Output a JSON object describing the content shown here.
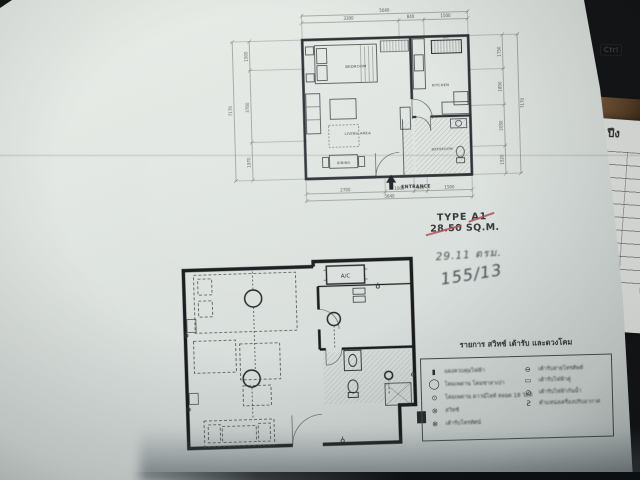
{
  "colors": {
    "background": "#131416",
    "paper": "#dde3df",
    "ink": "#30343a",
    "wall_ink": "#1a1c1e",
    "red_mark": "#b3505e",
    "pencil": "#4b5054"
  },
  "upper_plan": {
    "labels": {
      "bedroom": "BEDROOM",
      "living": "LIVING AREA",
      "dining": "DINING",
      "kitchen": "KITCHEN",
      "bathroom": "BATHROOM",
      "ac": "A/C",
      "entrance": "ENTRANCE"
    },
    "dims": {
      "top_total": "5640",
      "top_segments": [
        "3300",
        "840",
        "1500"
      ],
      "left_total": "7170",
      "left_segments": [
        "1500",
        "3700",
        "1970"
      ],
      "right_total": "7170",
      "right_segments": [
        "1750",
        "1850",
        "2050",
        "1520"
      ],
      "bottom_total": "5640",
      "bottom_segments": [
        "2700",
        "1000",
        "440",
        "1500"
      ]
    }
  },
  "type_block": {
    "line1": "TYPE A1",
    "line2": "28.50 SQ.M."
  },
  "handwriting": {
    "line1": "29.11 ตรม.",
    "line2": "155/13"
  },
  "lower_plan": {
    "ac_label": "A/C"
  },
  "legend": {
    "title": "รายการ สวิทช์ เต้ารับ และดวงโคม",
    "left": [
      {
        "name": "load-center-symbol",
        "glyph": "▮",
        "label": "แผงควบคุมไฟฟ้า"
      },
      {
        "name": "ceiling-lamp-symbol",
        "glyph": "◯",
        "label": "โคมเพดาน โคมซาลาเปา"
      },
      {
        "name": "downlight-symbol",
        "glyph": "⊙",
        "label": "โคมเพดาน ดาวน์ไลท์ หลอด 18 วัตต์"
      },
      {
        "name": "switch-symbol",
        "glyph": "⊚",
        "label": "สวิทช์"
      },
      {
        "name": "tv-outlet-symbol",
        "glyph": "⊗",
        "label": "เต้ารับโทรทัศน์"
      }
    ],
    "right": [
      {
        "name": "telephone-outlet-symbol",
        "glyph": "⊖",
        "label": "เต้ารับสายโทรศัพท์"
      },
      {
        "name": "duplex-outlet-symbol",
        "glyph": "▭",
        "label": "เต้ารับไฟฟ้าคู่"
      },
      {
        "name": "waterproof-outlet-symbol",
        "glyph": "⊘",
        "label": "เต้ารับไฟฟ้ากันน้ำ"
      },
      {
        "name": "aircon-position-symbol",
        "glyph": "Ƨ",
        "label": "ตำแหน่งเครื่องปรับอากาศ"
      }
    ]
  },
  "side_sheet": {
    "header_fragment": "ปีง"
  },
  "background": {
    "keyboard_key": "Ctrl"
  }
}
